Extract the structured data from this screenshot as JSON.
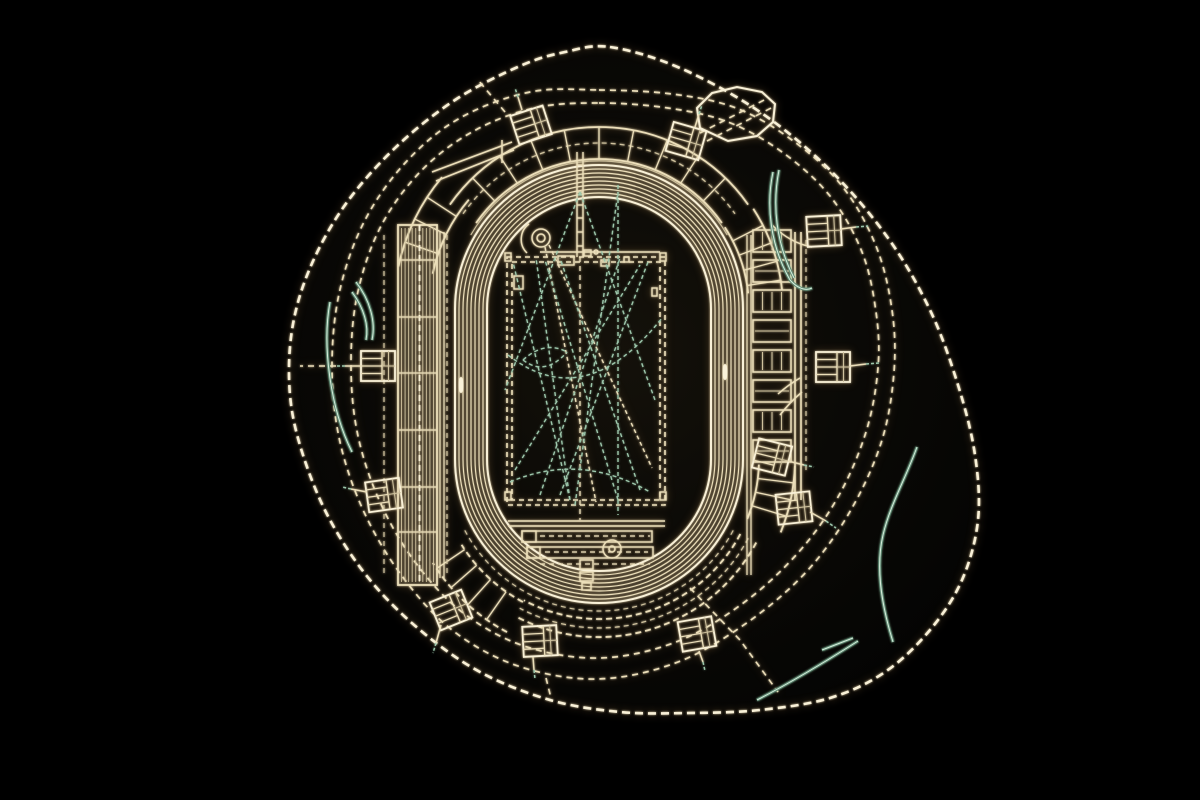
{
  "colors": {
    "background": "#000000",
    "site_fill_center": "#14110a",
    "site_fill_mid": "#0a0906",
    "site_fill_edge": "#040403",
    "cream": "#ecdfba",
    "cream_bright": "#f9f1d8",
    "cream_dim": "#cfc29e",
    "green": "#9dc7ac",
    "green_bright": "#d6ecda",
    "green_dark": "#5f8a74"
  },
  "plan": {
    "canvas": {
      "w": 1200,
      "h": 800
    },
    "boundary": [
      [
        610,
        47
      ],
      [
        680,
        68
      ],
      [
        760,
        112
      ],
      [
        830,
        170
      ],
      [
        888,
        238
      ],
      [
        930,
        310
      ],
      [
        958,
        385
      ],
      [
        975,
        455
      ],
      [
        978,
        520
      ],
      [
        962,
        580
      ],
      [
        930,
        630
      ],
      [
        885,
        672
      ],
      [
        830,
        698
      ],
      [
        760,
        710
      ],
      [
        690,
        713
      ],
      [
        620,
        712
      ],
      [
        550,
        700
      ],
      [
        480,
        672
      ],
      [
        420,
        630
      ],
      [
        370,
        580
      ],
      [
        330,
        520
      ],
      [
        303,
        455
      ],
      [
        290,
        395
      ],
      [
        292,
        330
      ],
      [
        310,
        268
      ],
      [
        345,
        205
      ],
      [
        395,
        148
      ],
      [
        455,
        100
      ],
      [
        520,
        66
      ],
      [
        565,
        52
      ]
    ],
    "ring_outer": [
      [
        599,
        90
      ],
      [
        672,
        94
      ],
      [
        736,
        108
      ],
      [
        792,
        140
      ],
      [
        842,
        186
      ],
      [
        876,
        246
      ],
      [
        892,
        310
      ],
      [
        894,
        372
      ],
      [
        882,
        440
      ],
      [
        852,
        508
      ],
      [
        808,
        570
      ],
      [
        748,
        622
      ],
      [
        678,
        662
      ],
      [
        598,
        679
      ],
      [
        518,
        666
      ],
      [
        452,
        630
      ],
      [
        402,
        576
      ],
      [
        364,
        512
      ],
      [
        340,
        442
      ],
      [
        332,
        370
      ],
      [
        339,
        294
      ],
      [
        364,
        222
      ],
      [
        406,
        162
      ],
      [
        460,
        118
      ],
      [
        530,
        92
      ]
    ],
    "ring_inner": [
      [
        599,
        103
      ],
      [
        668,
        108
      ],
      [
        728,
        122
      ],
      [
        782,
        152
      ],
      [
        830,
        196
      ],
      [
        862,
        252
      ],
      [
        876,
        312
      ],
      [
        878,
        368
      ],
      [
        866,
        432
      ],
      [
        838,
        497
      ],
      [
        797,
        554
      ],
      [
        742,
        604
      ],
      [
        676,
        642
      ],
      [
        600,
        658
      ],
      [
        524,
        646
      ],
      [
        462,
        612
      ],
      [
        415,
        562
      ],
      [
        380,
        502
      ],
      [
        358,
        436
      ],
      [
        351,
        368
      ],
      [
        357,
        296
      ],
      [
        380,
        228
      ],
      [
        420,
        172
      ],
      [
        472,
        132
      ],
      [
        534,
        108
      ]
    ],
    "spurs": [
      [
        [
          505,
          112
        ],
        [
          478,
          80
        ]
      ],
      [
        [
          690,
          588
        ],
        [
          740,
          640
        ],
        [
          778,
          692
        ]
      ],
      [
        [
          336,
          366
        ],
        [
          300,
          366
        ]
      ],
      [
        [
          546,
          678
        ],
        [
          551,
          698
        ]
      ]
    ],
    "octagon": [
      [
        700,
        128
      ],
      [
        697,
        108
      ],
      [
        712,
        93
      ],
      [
        737,
        87
      ],
      [
        762,
        92
      ],
      [
        775,
        104
      ],
      [
        773,
        122
      ],
      [
        757,
        136
      ],
      [
        728,
        141
      ]
    ],
    "octagon_road": [
      "M700,133 L768,98",
      "M707,141 L775,106"
    ],
    "track": {
      "cx": 599,
      "cy_top": 309,
      "cy_bottom": 459,
      "r_inner": 112,
      "r_outer": 144,
      "lane_step": 4,
      "lane_count": 9
    },
    "bands": [
      {
        "name": "north-stand",
        "cx": 599,
        "cy": 309,
        "r0": 150,
        "r1": 182,
        "a0": -145,
        "a1": -35,
        "edge": "solid",
        "mid": 166,
        "step": 11
      },
      {
        "name": "northwest-rooms",
        "cx": 599,
        "cy": 309,
        "r0": 170,
        "r1": 205,
        "a0": -168,
        "a1": -140,
        "edge": "solid",
        "mid": 0,
        "step": 7
      },
      {
        "name": "northeast-blocks",
        "cx": 599,
        "cy": 309,
        "r0": 150,
        "r1": 184,
        "a0": -33,
        "a1": -6,
        "edge": "solid",
        "mid": 0,
        "step": 6
      },
      {
        "name": "south-stand",
        "cx": 599,
        "cy": 459,
        "r0": 160,
        "r1": 178,
        "a0": 28,
        "a1": 118,
        "edge": "dash",
        "mid": 169,
        "step": 0
      },
      {
        "name": "southwest-stand",
        "cx": 599,
        "cy": 459,
        "r0": 162,
        "r1": 196,
        "a0": 118,
        "a1": 148,
        "edge": "dash",
        "mid": 0,
        "step": 7
      },
      {
        "name": "southeast-blocks",
        "cx": 599,
        "cy": 459,
        "r0": 160,
        "r1": 196,
        "a0": 2,
        "a1": 22,
        "edge": "solid",
        "mid": 0,
        "step": 5
      }
    ],
    "west_stand": {
      "x": 398,
      "w": 39,
      "y0": 225,
      "y1": 585,
      "rows": 11,
      "aisles": [
        260,
        317,
        373,
        430,
        487,
        532
      ],
      "center_x": 419.5,
      "outer_dash_x": 384
    },
    "east_stand": {
      "x": 753,
      "w": 38,
      "y0": 230,
      "blocks": 8,
      "block_h": 22,
      "gap": 8,
      "edges": [
        795,
        801
      ],
      "dash_x": 806
    },
    "walkways": {
      "lines": [
        [
          440,
          232,
          440,
          578
        ],
        [
          444,
          232,
          444,
          578
        ],
        [
          747,
          235,
          747,
          575
        ],
        [
          751,
          235,
          751,
          575
        ]
      ],
      "dlines": [
        [
          447,
          235,
          447,
          575
        ],
        [
          384,
          235,
          384,
          575
        ],
        [
          806,
          240,
          806,
          470
        ]
      ],
      "arc_bottom": {
        "cx": 599,
        "cy": 459,
        "r": 152,
        "a0": 28,
        "a1": 152
      },
      "arc_top": {
        "cx": 599,
        "cy": 309,
        "r": 148,
        "a0": -150,
        "a1": -30
      }
    },
    "pitch": {
      "drects": [
        [
          507,
          257,
          158,
          248
        ],
        [
          512,
          262,
          148,
          238
        ]
      ]
    },
    "infield": {
      "lines": [
        [
          508,
          521,
          665,
          521
        ],
        [
          508,
          526,
          665,
          526
        ],
        [
          577,
          152,
          577,
          257
        ],
        [
          583,
          152,
          583,
          257
        ],
        [
          577,
          165,
          583,
          165
        ],
        [
          577,
          178,
          583,
          178
        ],
        [
          577,
          192,
          583,
          192
        ],
        [
          577,
          205,
          583,
          205
        ],
        [
          577,
          218,
          583,
          218
        ],
        [
          577,
          232,
          583,
          232
        ],
        [
          577,
          246,
          583,
          246
        ],
        [
          540,
          252,
          660,
          252
        ]
      ],
      "rects": [
        [
          522,
          531,
          130,
          11
        ],
        [
          522,
          531,
          14,
          11
        ],
        [
          527,
          547,
          126,
          11
        ],
        [
          527,
          547,
          13,
          11
        ],
        [
          580,
          560,
          13,
          9
        ],
        [
          580,
          572,
          13,
          9
        ],
        [
          582,
          583,
          9,
          7
        ],
        [
          558,
          256,
          16,
          9
        ],
        [
          584,
          250,
          7,
          6
        ],
        [
          601,
          260,
          8,
          6
        ],
        [
          624,
          257,
          5,
          5
        ],
        [
          514,
          276,
          9,
          13
        ],
        [
          652,
          288,
          5,
          8
        ],
        [
          505,
          253,
          6,
          8
        ],
        [
          660,
          253,
          6,
          8
        ],
        [
          505,
          492,
          6,
          8
        ],
        [
          660,
          492,
          6,
          8
        ]
      ],
      "circles": [
        [
          541,
          238,
          9
        ],
        [
          541,
          238,
          4
        ],
        [
          612,
          549,
          9
        ],
        [
          612,
          549,
          3
        ],
        [
          596,
          252,
          2
        ]
      ],
      "ellipses": [
        [
          461,
          385,
          2.5,
          8
        ],
        [
          725,
          372,
          2.5,
          8
        ]
      ],
      "dlines": [
        [
          580,
          257,
          580,
          520
        ],
        [
          540,
          536,
          650,
          536
        ],
        [
          545,
          552,
          648,
          552
        ],
        [
          540,
          564,
          650,
          564
        ]
      ],
      "paths": [
        "M529,224 A19,19 0 0 0 527,253",
        "M432,172 L512,142",
        "M436,181 L514,150",
        "M502,140 L502,163",
        "M772,225 Q790,243 812,247",
        "M800,378 Q788,385 778,394",
        "M802,392 Q790,402 780,415"
      ]
    },
    "sector_lines": [
      {
        "p": [
          570,
          500,
          513,
          262
        ],
        "c": "g"
      },
      {
        "p": [
          570,
          500,
          536,
          258
        ],
        "c": "g"
      },
      {
        "p": [
          575,
          505,
          618,
          192
        ],
        "c": "g"
      },
      {
        "p": [
          560,
          495,
          648,
          262
        ],
        "c": "g"
      },
      {
        "p": [
          540,
          495,
          620,
          258
        ],
        "c": "g"
      },
      {
        "p": [
          618,
          500,
          545,
          260
        ],
        "c": "g"
      },
      {
        "p": [
          640,
          490,
          560,
          258
        ],
        "c": "g"
      },
      {
        "p": [
          580,
          192,
          505,
          390
        ],
        "c": "g"
      },
      {
        "p": [
          580,
          192,
          655,
          400
        ],
        "c": "g"
      },
      {
        "p": [
          515,
          470,
          640,
          265
        ],
        "c": "g"
      },
      {
        "p": [
          618,
          185,
          618,
          515
        ],
        "c": "g"
      },
      {
        "p": [
          545,
          247,
          596,
          502
        ],
        "c": "c"
      },
      {
        "p": [
          549,
          245,
          652,
          468
        ],
        "c": "c"
      }
    ],
    "sector_paths": [
      "M508,355 Q585,415 662,318",
      "M510,482 Q580,452 650,492",
      "M523,360 Q545,340 567,352",
      "M523,360 Q545,377 567,352"
    ],
    "gates": [
      {
        "cx": 531,
        "cy": 125,
        "rot": -18,
        "stalk": [
          [
            522,
            110
          ],
          [
            518,
            97
          ]
        ],
        "tip": [
          [
            518,
            97
          ],
          [
            515,
            88
          ]
        ]
      },
      {
        "cx": 686,
        "cy": 141,
        "rot": 16,
        "stalk": [
          [
            695,
            127
          ],
          [
            699,
            114
          ]
        ],
        "tip": [
          [
            699,
            114
          ],
          [
            702,
            105
          ]
        ]
      },
      {
        "cx": 824,
        "cy": 231,
        "rot": -3,
        "stalk": [
          [
            841,
            229
          ],
          [
            856,
            227
          ]
        ],
        "tip": [
          [
            856,
            227
          ],
          [
            868,
            226
          ]
        ]
      },
      {
        "cx": 833,
        "cy": 367,
        "rot": 0,
        "stalk": [
          [
            850,
            366
          ],
          [
            866,
            364
          ]
        ],
        "tip": [
          [
            866,
            364
          ],
          [
            879,
            363
          ]
        ]
      },
      {
        "cx": 794,
        "cy": 508,
        "rot": -6,
        "stalk": [
          [
            810,
            512
          ],
          [
            826,
            521
          ]
        ],
        "tip": [
          [
            826,
            521
          ],
          [
            836,
            528
          ]
        ]
      },
      {
        "cx": 451,
        "cy": 610,
        "rot": -22,
        "stalk": [
          [
            441,
            625
          ],
          [
            436,
            643
          ]
        ],
        "tip": [
          [
            436,
            643
          ],
          [
            433,
            653
          ]
        ]
      },
      {
        "cx": 540,
        "cy": 641,
        "rot": -3,
        "stalk": [
          [
            533,
            657
          ],
          [
            534,
            670
          ]
        ],
        "tip": [
          [
            534,
            670
          ],
          [
            535,
            679
          ]
        ]
      },
      {
        "cx": 697,
        "cy": 634,
        "rot": -10,
        "stalk": [
          [
            699,
            651
          ],
          [
            703,
            662
          ]
        ],
        "tip": [
          [
            703,
            662
          ],
          [
            705,
            671
          ]
        ]
      },
      {
        "cx": 378,
        "cy": 366,
        "rot": 0,
        "stalk": [
          [
            361,
            366
          ],
          [
            345,
            366
          ]
        ],
        "tip": [
          [
            345,
            366
          ],
          [
            336,
            366
          ]
        ]
      },
      {
        "cx": 384,
        "cy": 495,
        "rot": -8,
        "stalk": [
          [
            367,
            492
          ],
          [
            351,
            489
          ]
        ],
        "tip": [
          [
            351,
            489
          ],
          [
            342,
            487
          ]
        ]
      },
      {
        "cx": 772,
        "cy": 457,
        "rot": 14,
        "stalk": [
          [
            788,
            461
          ],
          [
            804,
            465
          ]
        ],
        "tip": [
          [
            804,
            465
          ],
          [
            814,
            467
          ]
        ]
      }
    ],
    "contours": [
      "M917,447 C905,480 890,505 883,535 C876,565 880,600 893,642",
      "M757,700 C790,683 825,662 858,641",
      "M330,302 C322,345 330,408 352,452",
      "M356,282 C370,300 376,322 372,340",
      "M352,292 C364,308 369,326 366,340",
      "M773,172 C766,205 770,245 790,280",
      "M779,170 C772,205 776,243 794,278",
      "M790,280 C798,289 806,291 812,288",
      "M822,650 L853,638"
    ]
  }
}
